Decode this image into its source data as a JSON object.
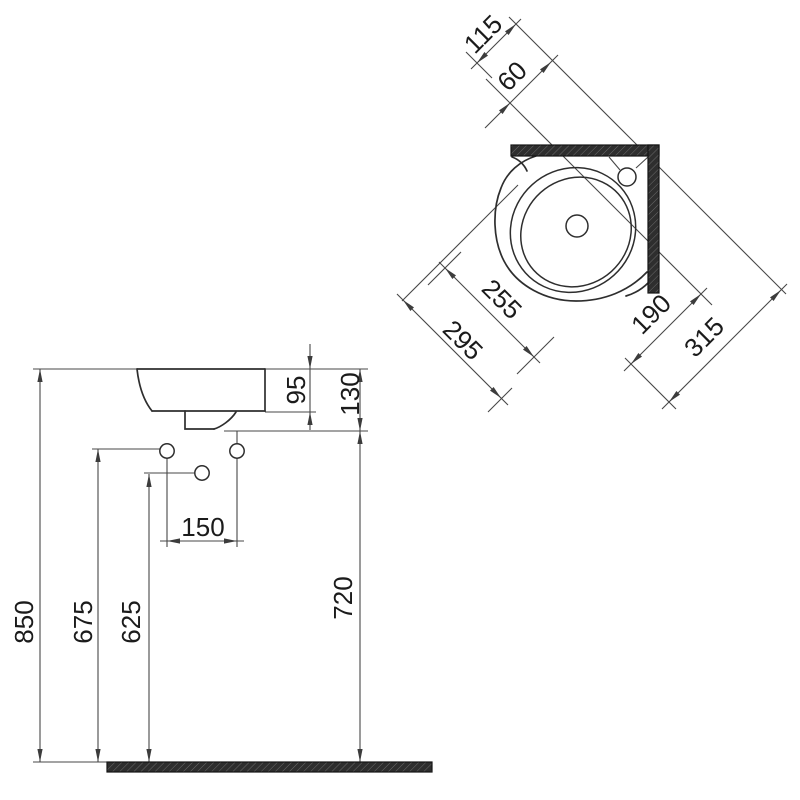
{
  "drawing": {
    "plan_view": {
      "dims": {
        "d115": "115",
        "d60": "60",
        "d255": "255",
        "d295": "295",
        "d190": "190",
        "d315": "315"
      }
    },
    "front_view": {
      "dims": {
        "d95": "95",
        "d130": "130",
        "d150": "150",
        "d850": "850",
        "d675": "675",
        "d625": "625",
        "d720": "720"
      }
    },
    "colors": {
      "background": "#ffffff",
      "line": "#474747",
      "profile": "#2e2e2e",
      "text": "#1b1b1b",
      "wall_fill": "#2e2e2e",
      "wall_hatch": "#6a6a6a"
    }
  }
}
